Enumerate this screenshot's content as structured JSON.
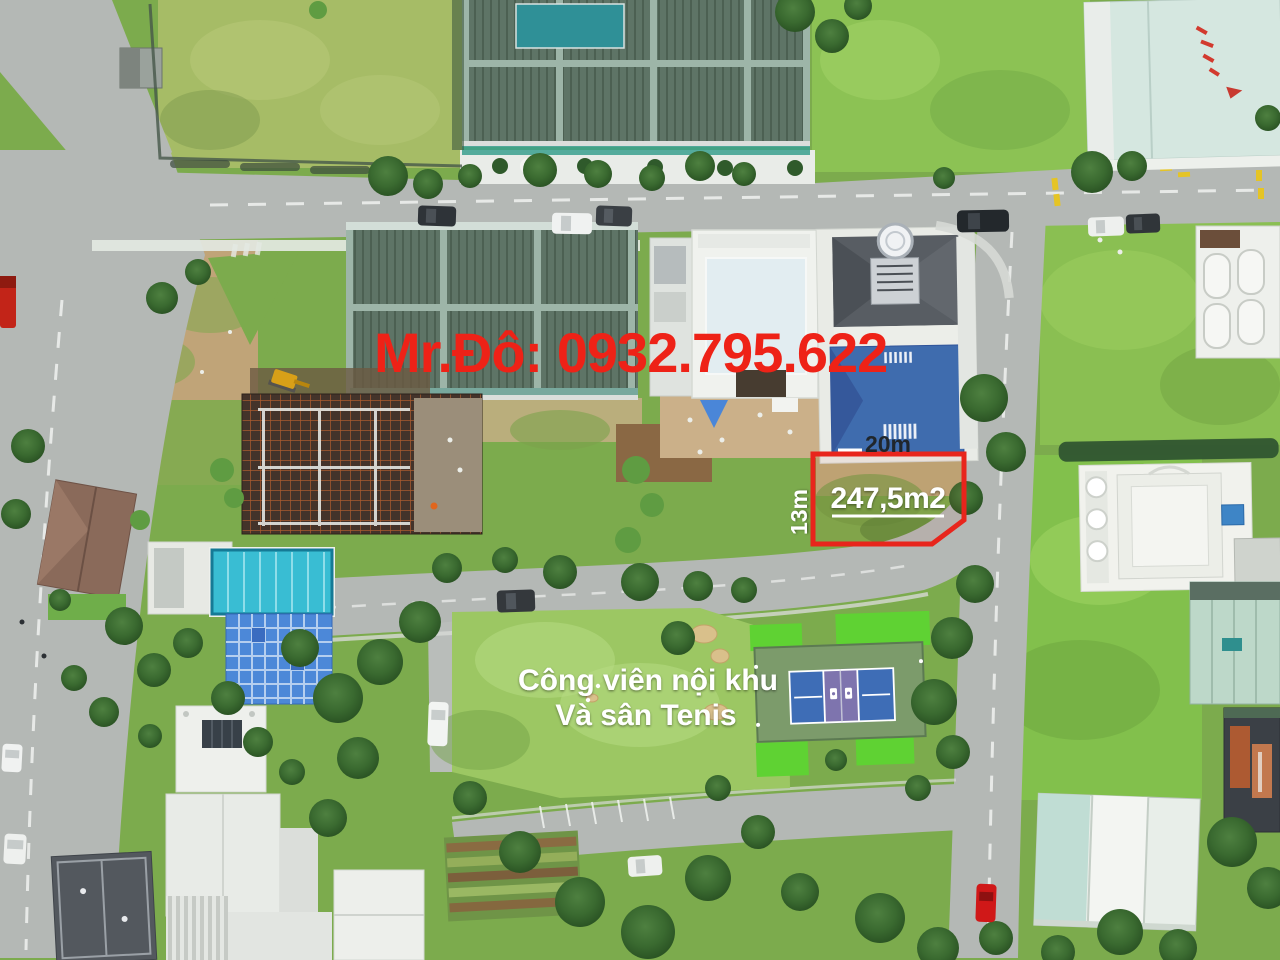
{
  "annotations": {
    "agent_watermark": {
      "text": "Mr.Đô: 0932.795.622",
      "color": "#ee2217"
    },
    "plot": {
      "area_label": "247,5m2",
      "frontage_label": "20m",
      "depth_label": "13m",
      "outline_color": "#e8251c",
      "area_label_color": "#ffffff",
      "frontage_label_color": "#20262c",
      "depth_label_color": "#ffffff"
    },
    "park_label": {
      "line1": "Công viên nội khu",
      "line2": "Và sân Tenis",
      "color": "#ffffff"
    }
  },
  "scene_colors": {
    "road": "#b4b8b5",
    "grass_base": "#7cab4d",
    "warehouse_roof": "#5e7466",
    "warehouse_beam": "#9db5a8",
    "villa_blue_roof": "#3f6cae",
    "villa_gray_roof": "#585d63",
    "pool_cyan": "#39bdd3",
    "tarp_blue": "#4c88d8",
    "tennis_blue": "#3e6db6",
    "tennis_purple": "#7e74ae",
    "tennis_apron": "#7c9b6b",
    "tennis_pad_green": "#5fd233",
    "construction_rust": "#a85a2e",
    "dirt": "#c6ae85",
    "teal_roof": "#c0ddd4"
  }
}
